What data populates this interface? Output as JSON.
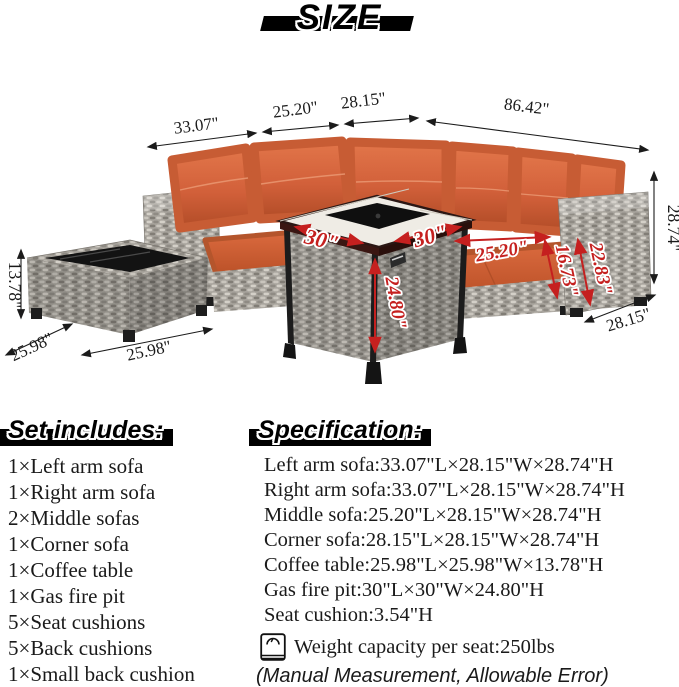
{
  "title": "SIZE",
  "dims": {
    "left_sofa_len": "33.07\"",
    "middle_sofa_len": "25.20\"",
    "corner_len": "28.15\"",
    "total_len": "86.42\"",
    "sofa_height": "28.74\"",
    "sofa_depth": "28.15\"",
    "table_height": "13.78\"",
    "table_depth": "25.98\"",
    "table_len": "25.98\"",
    "firepit_w": "30\"",
    "firepit_d": "30\"",
    "firepit_h": "24.80\"",
    "seat_len": "25.20\"",
    "seat_depth": "16.73\"",
    "arm_height": "22.83\""
  },
  "set_includes": {
    "heading": "Set includes:",
    "items": [
      "1×Left arm sofa",
      "1×Right arm sofa",
      "2×Middle sofas",
      "1×Corner sofa",
      "1×Coffee table",
      "1×Gas fire pit",
      "5×Seat cushions",
      "5×Back cushions",
      "1×Small back cushion"
    ]
  },
  "specification": {
    "heading": "Specification:",
    "items": [
      "Left arm sofa:33.07\"L×28.15\"W×28.74\"H",
      "Right arm sofa:33.07\"L×28.15\"W×28.74\"H",
      "Middle sofa:25.20\"L×28.15\"W×28.74\"H",
      "Corner sofa:28.15\"L×28.15\"W×28.74\"H",
      "Coffee table:25.98\"L×25.98\"W×13.78\"H",
      "Gas fire pit:30\"L×30\"W×24.80\"H",
      "Seat cushion:3.54\"H"
    ],
    "weight_capacity": "Weight capacity per seat:250lbs",
    "note": "(Manual Measurement, Allowable Error)"
  },
  "colors": {
    "cushion_orange": "#d2603a",
    "wicker_gray": "#a8a49d",
    "dimension_red": "#c5201f",
    "text_black": "#1a1a1a"
  }
}
